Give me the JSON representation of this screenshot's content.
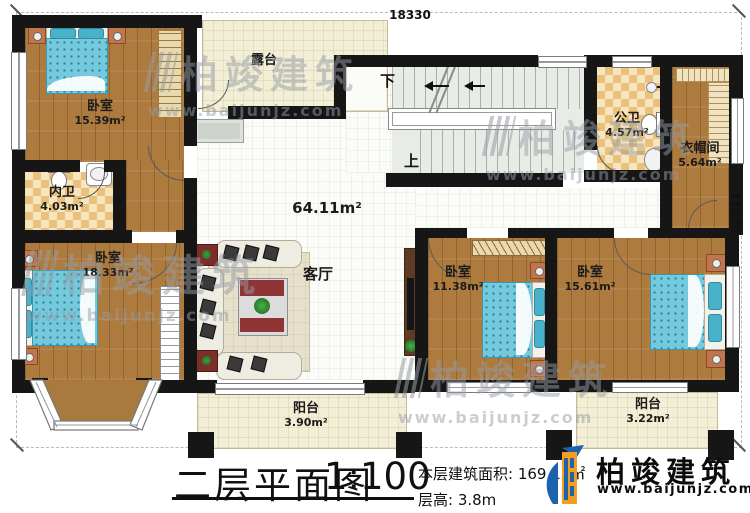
{
  "plan": {
    "dimension_top": "18330",
    "dimension_right": "11020",
    "stairs": {
      "down": "下",
      "up": "上"
    },
    "rooms": {
      "bedroom_tl": {
        "name": "卧室",
        "area": "15.39m²"
      },
      "bath_inner": {
        "name": "内卫",
        "area": "4.03m²"
      },
      "bedroom_bl": {
        "name": "卧室",
        "area": "18.33m²"
      },
      "terrace": {
        "name": "露台"
      },
      "living": {
        "name": "客厅",
        "area": "64.11m²"
      },
      "bath_public": {
        "name": "公卫",
        "area": "4.57m²"
      },
      "cloakroom": {
        "name": "衣帽间",
        "area": "5.64m²"
      },
      "bedroom_mid": {
        "name": "卧室",
        "area": "11.38m²"
      },
      "bedroom_br": {
        "name": "卧室",
        "area": "15.61m²"
      },
      "balcony_left": {
        "name": "阳台",
        "area": "3.90m²"
      },
      "balcony_right": {
        "name": "阳台",
        "area": "3.22m²"
      }
    }
  },
  "footer": {
    "title": "二层平面图",
    "scale": "1:100",
    "area_text": "本层建筑面积: 169.12㎡",
    "height_text": "层高: 3.8m"
  },
  "brand": {
    "name": "柏竣建筑",
    "url": "www.baijunjz.com"
  },
  "watermark": {
    "name": "柏竣建筑",
    "url": "www.baijunjz.com"
  },
  "colors": {
    "wall": "#161616",
    "wood_floor": "#ad7b3e",
    "tile_checker": "#e9c17c",
    "terrace_cream": "#f3eed6",
    "bed_teal": "#74c9dc",
    "logo_blue": "#1b63ad",
    "logo_orange": "#f59d1f"
  }
}
